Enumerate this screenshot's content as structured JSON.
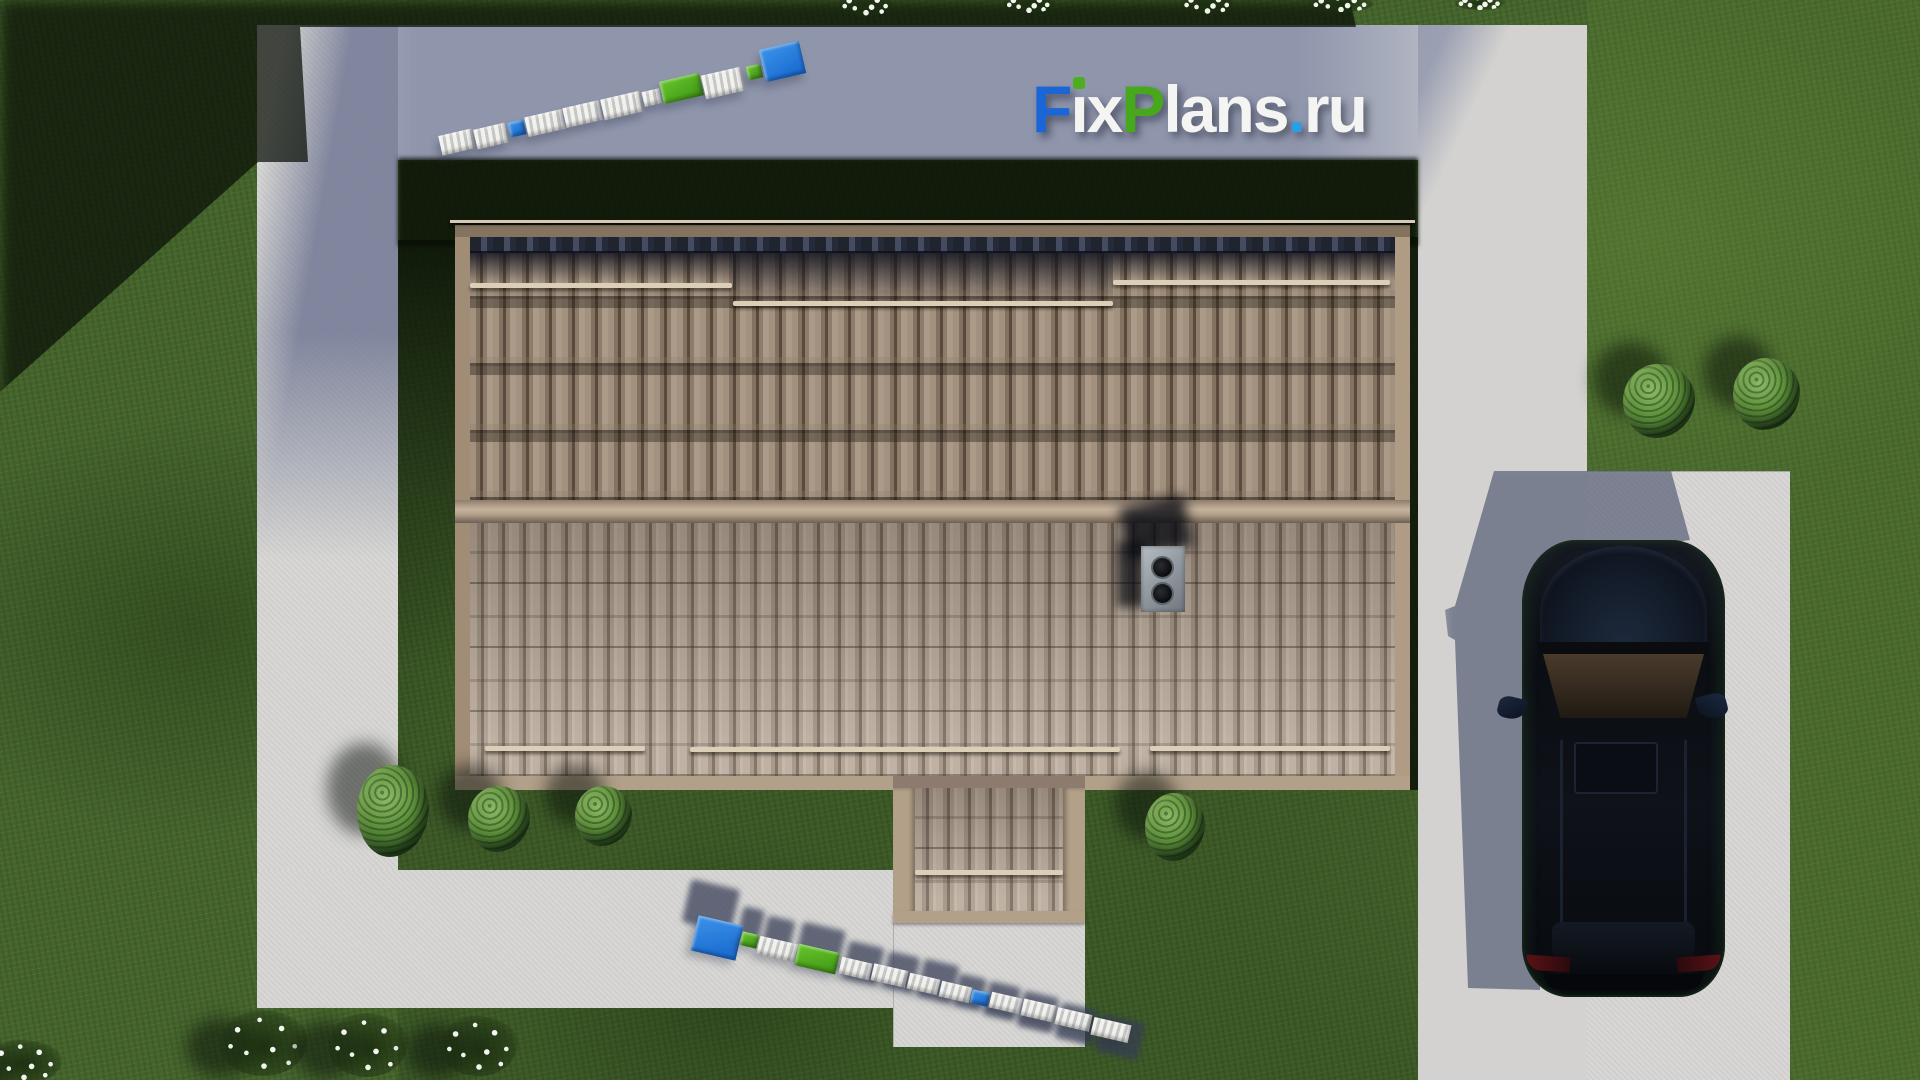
{
  "meta": {
    "description": "Aerial top-down 3D render of a house: tiled roof with chimney and porch, concrete walkways, driveway with parked dark SUV, lawns, bushes and flowers; FixPlans.ru watermark",
    "brand": "FixPlans.ru"
  },
  "logo": {
    "text": "FixPlans.ru",
    "shadow_color": "rgba(22,26,44,0.5)",
    "segments": [
      {
        "ch": "F",
        "color": "#1b66d6"
      },
      {
        "ch": "ı",
        "color": "#f4f4f2",
        "tittle": "#4fae1f"
      },
      {
        "ch": "x",
        "color": "#f4f4f2"
      },
      {
        "ch": "P",
        "color": "#47a81c"
      },
      {
        "ch": "l",
        "color": "#f4f4f2"
      },
      {
        "ch": "a",
        "color": "#f4f4f2"
      },
      {
        "ch": "n",
        "color": "#f4f4f2"
      },
      {
        "ch": "s",
        "color": "#f4f4f2"
      },
      {
        "ch": ".",
        "color": "#2b9fe4"
      },
      {
        "ch": "r",
        "color": "#f4f4f2"
      },
      {
        "ch": "u",
        "color": "#f4f4f2"
      }
    ]
  },
  "scene": {
    "palette": {
      "lawn": "#44642b",
      "lawn_shadow": "#101d0a",
      "concrete": "#d8d7d5",
      "concrete_shadow": "#8f95ab",
      "tile_upper": "#8d7c6d",
      "tile_lower": "#a29182",
      "ridge": "#b9a68f",
      "fascia": "#ab977f",
      "car_body": "#0c1016",
      "wm_white": "#ededeb",
      "wm_blue": "#1e79dc",
      "wm_green": "#4fb01c"
    },
    "roof": {
      "rails_upper": [
        {
          "x": 470,
          "y": 283,
          "w": 262
        },
        {
          "x": 733,
          "y": 301,
          "w": 380
        },
        {
          "x": 1113,
          "y": 280,
          "w": 277
        }
      ],
      "rails_lower": [
        {
          "x": 485,
          "y": 746,
          "w": 160
        },
        {
          "x": 690,
          "y": 747,
          "w": 430
        },
        {
          "x": 1150,
          "y": 746,
          "w": 240
        }
      ],
      "porch_rail": {
        "x": 915,
        "y": 870,
        "w": 148
      },
      "chimney": {
        "x": 1141,
        "y": 546,
        "w": 44,
        "h": 66,
        "vent_count": 2
      }
    },
    "car": {
      "x": 1522,
      "y": 540,
      "w": 203,
      "h": 457,
      "body_color": "#0c1016",
      "windshield_color": "#46382a"
    },
    "bushes": [
      {
        "x": 357,
        "y": 765,
        "w": 72,
        "h": 92
      },
      {
        "x": 468,
        "y": 786,
        "w": 62,
        "h": 66
      },
      {
        "x": 575,
        "y": 786,
        "w": 57,
        "h": 60
      },
      {
        "x": 1145,
        "y": 793,
        "w": 60,
        "h": 68
      },
      {
        "x": 1623,
        "y": 364,
        "w": 72,
        "h": 74
      },
      {
        "x": 1733,
        "y": 358,
        "w": 67,
        "h": 72
      }
    ],
    "flowers": [
      {
        "x": 838,
        "y": -6,
        "w": 56,
        "h": 22
      },
      {
        "x": 1003,
        "y": -5,
        "w": 52,
        "h": 18
      },
      {
        "x": 1180,
        "y": -6,
        "w": 55,
        "h": 20
      },
      {
        "x": 1308,
        "y": -4,
        "w": 66,
        "h": 16
      },
      {
        "x": 1455,
        "y": -4,
        "w": 50,
        "h": 14
      },
      {
        "x": -14,
        "y": 1040,
        "w": 76,
        "h": 44,
        "sh": true
      },
      {
        "x": 220,
        "y": 1010,
        "w": 88,
        "h": 66,
        "sh": true
      },
      {
        "x": 328,
        "y": 1013,
        "w": 80,
        "h": 64,
        "sh": true
      },
      {
        "x": 440,
        "y": 1016,
        "w": 78,
        "h": 60,
        "sh": true
      }
    ],
    "wm_top_blocks": [
      {
        "x": 440,
        "y": 132,
        "w": 34,
        "h": 20,
        "c": "#ededeb",
        "rot": -13
      },
      {
        "x": 475,
        "y": 126,
        "w": 32,
        "h": 20,
        "c": "#ededeb",
        "rot": -13
      },
      {
        "x": 509,
        "y": 121,
        "w": 16,
        "h": 15,
        "c": "#1e79dc",
        "rot": -13
      },
      {
        "x": 526,
        "y": 113,
        "w": 38,
        "h": 20,
        "c": "#ededeb",
        "rot": -13
      },
      {
        "x": 564,
        "y": 104,
        "w": 37,
        "h": 20,
        "c": "#ededeb",
        "rot": -13
      },
      {
        "x": 602,
        "y": 95,
        "w": 40,
        "h": 21,
        "c": "#ededeb",
        "rot": -13
      },
      {
        "x": 643,
        "y": 90,
        "w": 18,
        "h": 15,
        "c": "#ededeb",
        "rot": -13
      },
      {
        "x": 661,
        "y": 77,
        "w": 41,
        "h": 23,
        "c": "#4fb01c",
        "rot": -13
      },
      {
        "x": 703,
        "y": 71,
        "w": 40,
        "h": 24,
        "c": "#ededeb",
        "rot": -13
      },
      {
        "x": 747,
        "y": 65,
        "w": 15,
        "h": 14,
        "c": "#4fb01c",
        "rot": -13
      },
      {
        "x": 762,
        "y": 45,
        "w": 41,
        "h": 33,
        "c": "#1e79dc",
        "rot": -13
      }
    ],
    "wm_bottom_blocks": [
      {
        "x": 694,
        "y": 920,
        "w": 46,
        "h": 36,
        "c": "#1e9ae4",
        "rot": 13
      },
      {
        "x": 741,
        "y": 933,
        "w": 17,
        "h": 14,
        "c": "#4fb01c",
        "rot": 13
      },
      {
        "x": 758,
        "y": 940,
        "w": 39,
        "h": 18,
        "c": "#ededeb",
        "rot": 13
      },
      {
        "x": 796,
        "y": 948,
        "w": 42,
        "h": 22,
        "c": "#4fb01c",
        "rot": 13
      },
      {
        "x": 840,
        "y": 960,
        "w": 31,
        "h": 17,
        "c": "#ededeb",
        "rot": 13
      },
      {
        "x": 872,
        "y": 967,
        "w": 35,
        "h": 17,
        "c": "#ededeb",
        "rot": 13
      },
      {
        "x": 908,
        "y": 976,
        "w": 31,
        "h": 16,
        "c": "#ededeb",
        "rot": 13
      },
      {
        "x": 940,
        "y": 984,
        "w": 31,
        "h": 16,
        "c": "#ededeb",
        "rot": 13
      },
      {
        "x": 971,
        "y": 991,
        "w": 18,
        "h": 14,
        "c": "#1e9ae4",
        "rot": 13
      },
      {
        "x": 990,
        "y": 995,
        "w": 31,
        "h": 16,
        "c": "#ededeb",
        "rot": 13
      },
      {
        "x": 1022,
        "y": 1002,
        "w": 33,
        "h": 17,
        "c": "#ededeb",
        "rot": 13
      },
      {
        "x": 1056,
        "y": 1011,
        "w": 35,
        "h": 17,
        "c": "#ededeb",
        "rot": 13
      },
      {
        "x": 1092,
        "y": 1021,
        "w": 38,
        "h": 18,
        "c": "#ededeb",
        "rot": 13
      }
    ],
    "wm_bottom_shadows": [
      {
        "x": 686,
        "y": 884,
        "w": 50,
        "h": 44,
        "rot": 13
      },
      {
        "x": 740,
        "y": 908,
        "w": 22,
        "h": 32,
        "rot": 13
      },
      {
        "x": 764,
        "y": 918,
        "w": 28,
        "h": 36,
        "rot": 13
      },
      {
        "x": 798,
        "y": 926,
        "w": 44,
        "h": 42,
        "rot": 13
      },
      {
        "x": 845,
        "y": 944,
        "w": 36,
        "h": 38,
        "rot": 13
      },
      {
        "x": 885,
        "y": 954,
        "w": 32,
        "h": 36,
        "rot": 13
      },
      {
        "x": 920,
        "y": 962,
        "w": 36,
        "h": 38,
        "rot": 13
      },
      {
        "x": 956,
        "y": 976,
        "w": 28,
        "h": 32,
        "rot": 13
      },
      {
        "x": 986,
        "y": 984,
        "w": 32,
        "h": 34,
        "rot": 13
      },
      {
        "x": 1020,
        "y": 994,
        "w": 36,
        "h": 36,
        "rot": 13
      },
      {
        "x": 1058,
        "y": 1006,
        "w": 38,
        "h": 36,
        "rot": 13
      },
      {
        "x": 1098,
        "y": 1018,
        "w": 44,
        "h": 38,
        "rot": 13
      }
    ]
  }
}
